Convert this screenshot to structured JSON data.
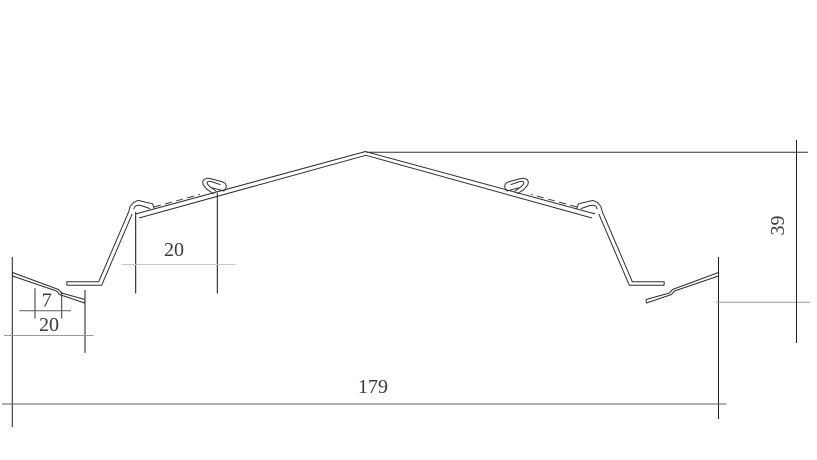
{
  "drawing": {
    "kind": "roof-panel-profile-cross-section",
    "units": "mm",
    "mirror_axis": 731,
    "stroke_color": "#2e2e2e",
    "hidden_line_color": "#3c3c3c"
  },
  "dimensions": {
    "slope_pitch": {
      "label": "20",
      "value": 20
    },
    "eave_lip": {
      "label": "7",
      "value": 7
    },
    "eave_tab": {
      "label": "20",
      "value": 20
    },
    "overall_width": {
      "label": "179",
      "value": 179
    },
    "overall_height": {
      "label": "39",
      "value": 39
    }
  },
  "geometry": {
    "profile": [
      {
        "name": "eave-tab",
        "closed": true,
        "mirror": true,
        "dashed": false,
        "points": [
          [
            12.5,
            272.5
          ],
          [
            58.5,
            289.5
          ],
          [
            61.5,
            293
          ],
          [
            85,
            299.5
          ],
          [
            84.5,
            303
          ],
          [
            59.5,
            294.5
          ],
          [
            56.5,
            291
          ],
          [
            12.5,
            276
          ]
        ]
      },
      {
        "name": "flange-riser-hook-outer",
        "closed": false,
        "mirror": true,
        "dashed": false,
        "points": [
          [
            66.7,
            281.7
          ],
          [
            98.7,
            281.7
          ],
          [
            128.7,
            211.7
          ],
          [
            130.2,
            206.3
          ],
          [
            133.6,
            202.4
          ],
          [
            138,
            200.4
          ],
          [
            152.6,
            203.8
          ],
          [
            154.4,
            209
          ]
        ]
      },
      {
        "name": "flange-riser-inner",
        "closed": false,
        "mirror": true,
        "dashed": false,
        "points": [
          [
            66.7,
            281.7
          ],
          [
            67,
            285.2
          ],
          [
            101.7,
            285.2
          ],
          [
            132.2,
            213.9
          ]
        ]
      },
      {
        "name": "hook-inner",
        "closed": false,
        "mirror": true,
        "dashed": false,
        "points": [
          [
            133.8,
            209.2
          ],
          [
            135,
            206.3
          ],
          [
            137.6,
            205.2
          ],
          [
            140.5,
            205.4
          ],
          [
            150.2,
            208.6
          ]
        ]
      },
      {
        "name": "slope-upper-edge",
        "closed": false,
        "mirror": false,
        "dashed": false,
        "points": [
          [
            136,
            213.9
          ],
          [
            365.5,
            151.5
          ],
          [
            595,
            213.9
          ]
        ]
      },
      {
        "name": "slope-lower-edge",
        "closed": false,
        "mirror": false,
        "dashed": false,
        "points": [
          [
            139,
            218
          ],
          [
            365.8,
            155.3
          ],
          [
            592,
            218
          ]
        ]
      },
      {
        "name": "mid-clip-outer",
        "closed": false,
        "mirror": true,
        "dashed": false,
        "points": [
          [
            213.8,
            194
          ],
          [
            206.8,
            189.2
          ],
          [
            203.2,
            184.8
          ],
          [
            202.6,
            181.6
          ],
          [
            204.2,
            179.2
          ],
          [
            207.6,
            178.2
          ],
          [
            211.6,
            178.9
          ],
          [
            222.6,
            181.9
          ],
          [
            225.4,
            183.5
          ],
          [
            226.4,
            186
          ],
          [
            225.6,
            188.9
          ],
          [
            224,
            191
          ],
          [
            212.4,
            187.8
          ]
        ]
      },
      {
        "name": "mid-clip-inner",
        "closed": false,
        "mirror": true,
        "dashed": false,
        "points": [
          [
            216.4,
            191.4
          ],
          [
            209.4,
            186.3
          ],
          [
            207.2,
            183.7
          ],
          [
            207.5,
            181.9
          ],
          [
            209.6,
            181.2
          ],
          [
            212.4,
            181.9
          ],
          [
            220.4,
            184.7
          ]
        ]
      },
      {
        "name": "hidden-overlap-edge",
        "closed": false,
        "mirror": true,
        "dashed": true,
        "points": [
          [
            154,
            207
          ],
          [
            200,
            194.4
          ]
        ]
      }
    ],
    "guides": [
      {
        "name": "ext-left-edge",
        "x1": 12.3,
        "y1": 257,
        "x2": 12.3,
        "y2": 427,
        "color": "#1f1f1f"
      },
      {
        "name": "ext-tab-right",
        "x1": 85,
        "y1": 290,
        "x2": 85,
        "y2": 353,
        "color": "#1f1f1f"
      },
      {
        "name": "ext-lip-left",
        "x1": 35,
        "y1": 288.3,
        "x2": 35,
        "y2": 318.5,
        "color": "#333333"
      },
      {
        "name": "ext-lip-right",
        "x1": 61.7,
        "y1": 291.7,
        "x2": 61.7,
        "y2": 318.5,
        "color": "#333333"
      },
      {
        "name": "ext-pitch-left",
        "x1": 135.7,
        "y1": 212,
        "x2": 135.7,
        "y2": 293.5,
        "color": "#111111"
      },
      {
        "name": "ext-pitch-right",
        "x1": 217.3,
        "y1": 193,
        "x2": 217.3,
        "y2": 293.5,
        "color": "#111111"
      },
      {
        "name": "ext-width-right",
        "x1": 718.5,
        "y1": 257,
        "x2": 718.5,
        "y2": 419,
        "color": "#1f1f1f"
      },
      {
        "name": "ext-height-top",
        "x1": 366,
        "y1": 152.3,
        "x2": 808,
        "y2": 152.3,
        "color": "#333333"
      },
      {
        "name": "ext-height-bottom",
        "x1": 716,
        "y1": 302.3,
        "x2": 810,
        "y2": 302.3,
        "color": "#9b9b9b"
      },
      {
        "name": "dim-line-pitch",
        "x1": 121.5,
        "y1": 264.5,
        "x2": 235.5,
        "y2": 264.5,
        "color": "#c7c7c7"
      },
      {
        "name": "dim-line-lip",
        "x1": 19.3,
        "y1": 310.7,
        "x2": 71,
        "y2": 310.7,
        "color": "#5a5a5a"
      },
      {
        "name": "dim-line-tab",
        "x1": 4,
        "y1": 335.5,
        "x2": 93.5,
        "y2": 335.5,
        "color": "#9b9b9b"
      },
      {
        "name": "dim-line-width",
        "x1": 2,
        "y1": 404,
        "x2": 726.5,
        "y2": 404,
        "color": "#5f5f5f"
      },
      {
        "name": "dim-line-height",
        "x1": 796.5,
        "y1": 140,
        "x2": 796.5,
        "y2": 343,
        "color": "#222222"
      }
    ]
  }
}
